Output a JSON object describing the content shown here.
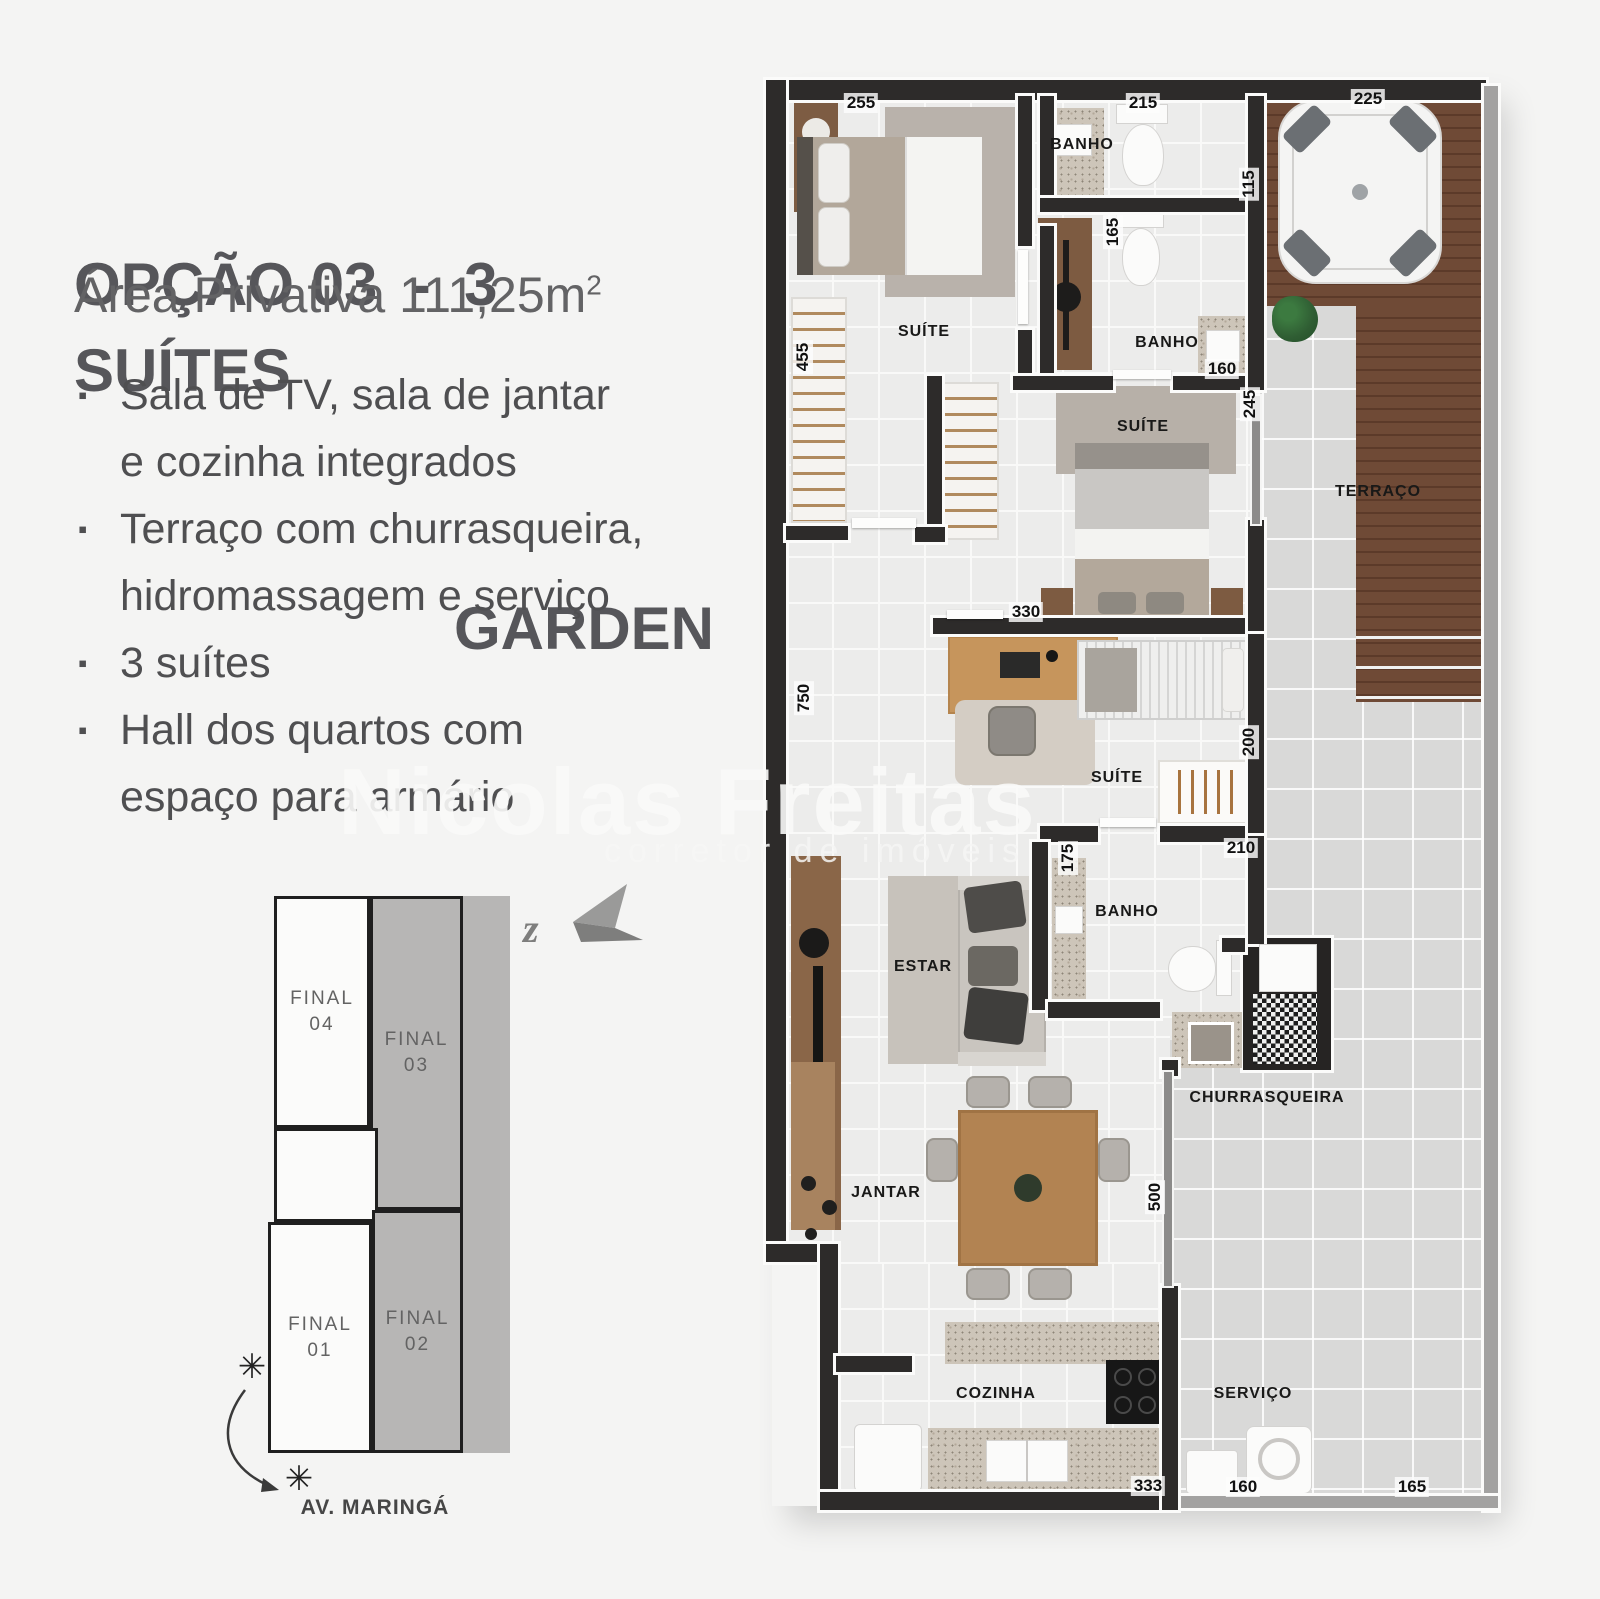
{
  "header": {
    "title_line1": "OPÇÃO 03  -  3 SUÍTES",
    "title_line2": "GARDEN",
    "area_text": "Área Privativa 111,25m",
    "area_sup": "2"
  },
  "features": {
    "bullet": "▪",
    "items": [
      {
        "lines": [
          "Sala de TV, sala de jantar",
          "e cozinha integrados"
        ]
      },
      {
        "lines": [
          "Terraço com churrasqueira,",
          "hidromassagem e serviço"
        ]
      },
      {
        "lines": [
          "3 suítes"
        ]
      },
      {
        "lines": [
          "Hall dos quartos com",
          "espaço para armário"
        ]
      }
    ]
  },
  "keyplan": {
    "units": [
      {
        "line1": "FINAL",
        "line2": "04"
      },
      {
        "line1": "FINAL",
        "line2": "03"
      },
      {
        "line1": "FINAL",
        "line2": "01"
      },
      {
        "line1": "FINAL",
        "line2": "02"
      }
    ],
    "street_label": "AV. MARINGÁ",
    "north_letter": "z",
    "sun_symbol": "✳"
  },
  "watermark": {
    "brand": "Nicolas Freitas",
    "tagline": "corretor de imóveis"
  },
  "floorplan": {
    "rooms": [
      {
        "id": "suite-1",
        "name": "SUÍTE"
      },
      {
        "id": "banho-1",
        "name": "BANHO"
      },
      {
        "id": "banho-2",
        "name": "BANHO"
      },
      {
        "id": "suite-2",
        "name": "SUÍTE"
      },
      {
        "id": "terraco",
        "name": "TERRAÇO"
      },
      {
        "id": "suite-3",
        "name": "SUÍTE"
      },
      {
        "id": "banho-3",
        "name": "BANHO"
      },
      {
        "id": "estar",
        "name": "ESTAR"
      },
      {
        "id": "churrasqueira",
        "name": "CHURRASQUEIRA"
      },
      {
        "id": "jantar",
        "name": "JANTAR"
      },
      {
        "id": "cozinha",
        "name": "COZINHA"
      },
      {
        "id": "servico",
        "name": "SERVIÇO"
      }
    ],
    "dims": [
      {
        "v": "255"
      },
      {
        "v": "215"
      },
      {
        "v": "225"
      },
      {
        "v": "115"
      },
      {
        "v": "165"
      },
      {
        "v": "455"
      },
      {
        "v": "160"
      },
      {
        "v": "245"
      },
      {
        "v": "330"
      },
      {
        "v": "750"
      },
      {
        "v": "200"
      },
      {
        "v": "210"
      },
      {
        "v": "175"
      },
      {
        "v": "500"
      },
      {
        "v": "333"
      },
      {
        "v": "160"
      },
      {
        "v": "165"
      }
    ]
  },
  "colors": {
    "wall": "#2d2b2a",
    "deck_wood": "#6f4a36",
    "keyplan_gray": "#b7b6b5",
    "background": "#f4f4f3",
    "title_text": "#56565a"
  }
}
